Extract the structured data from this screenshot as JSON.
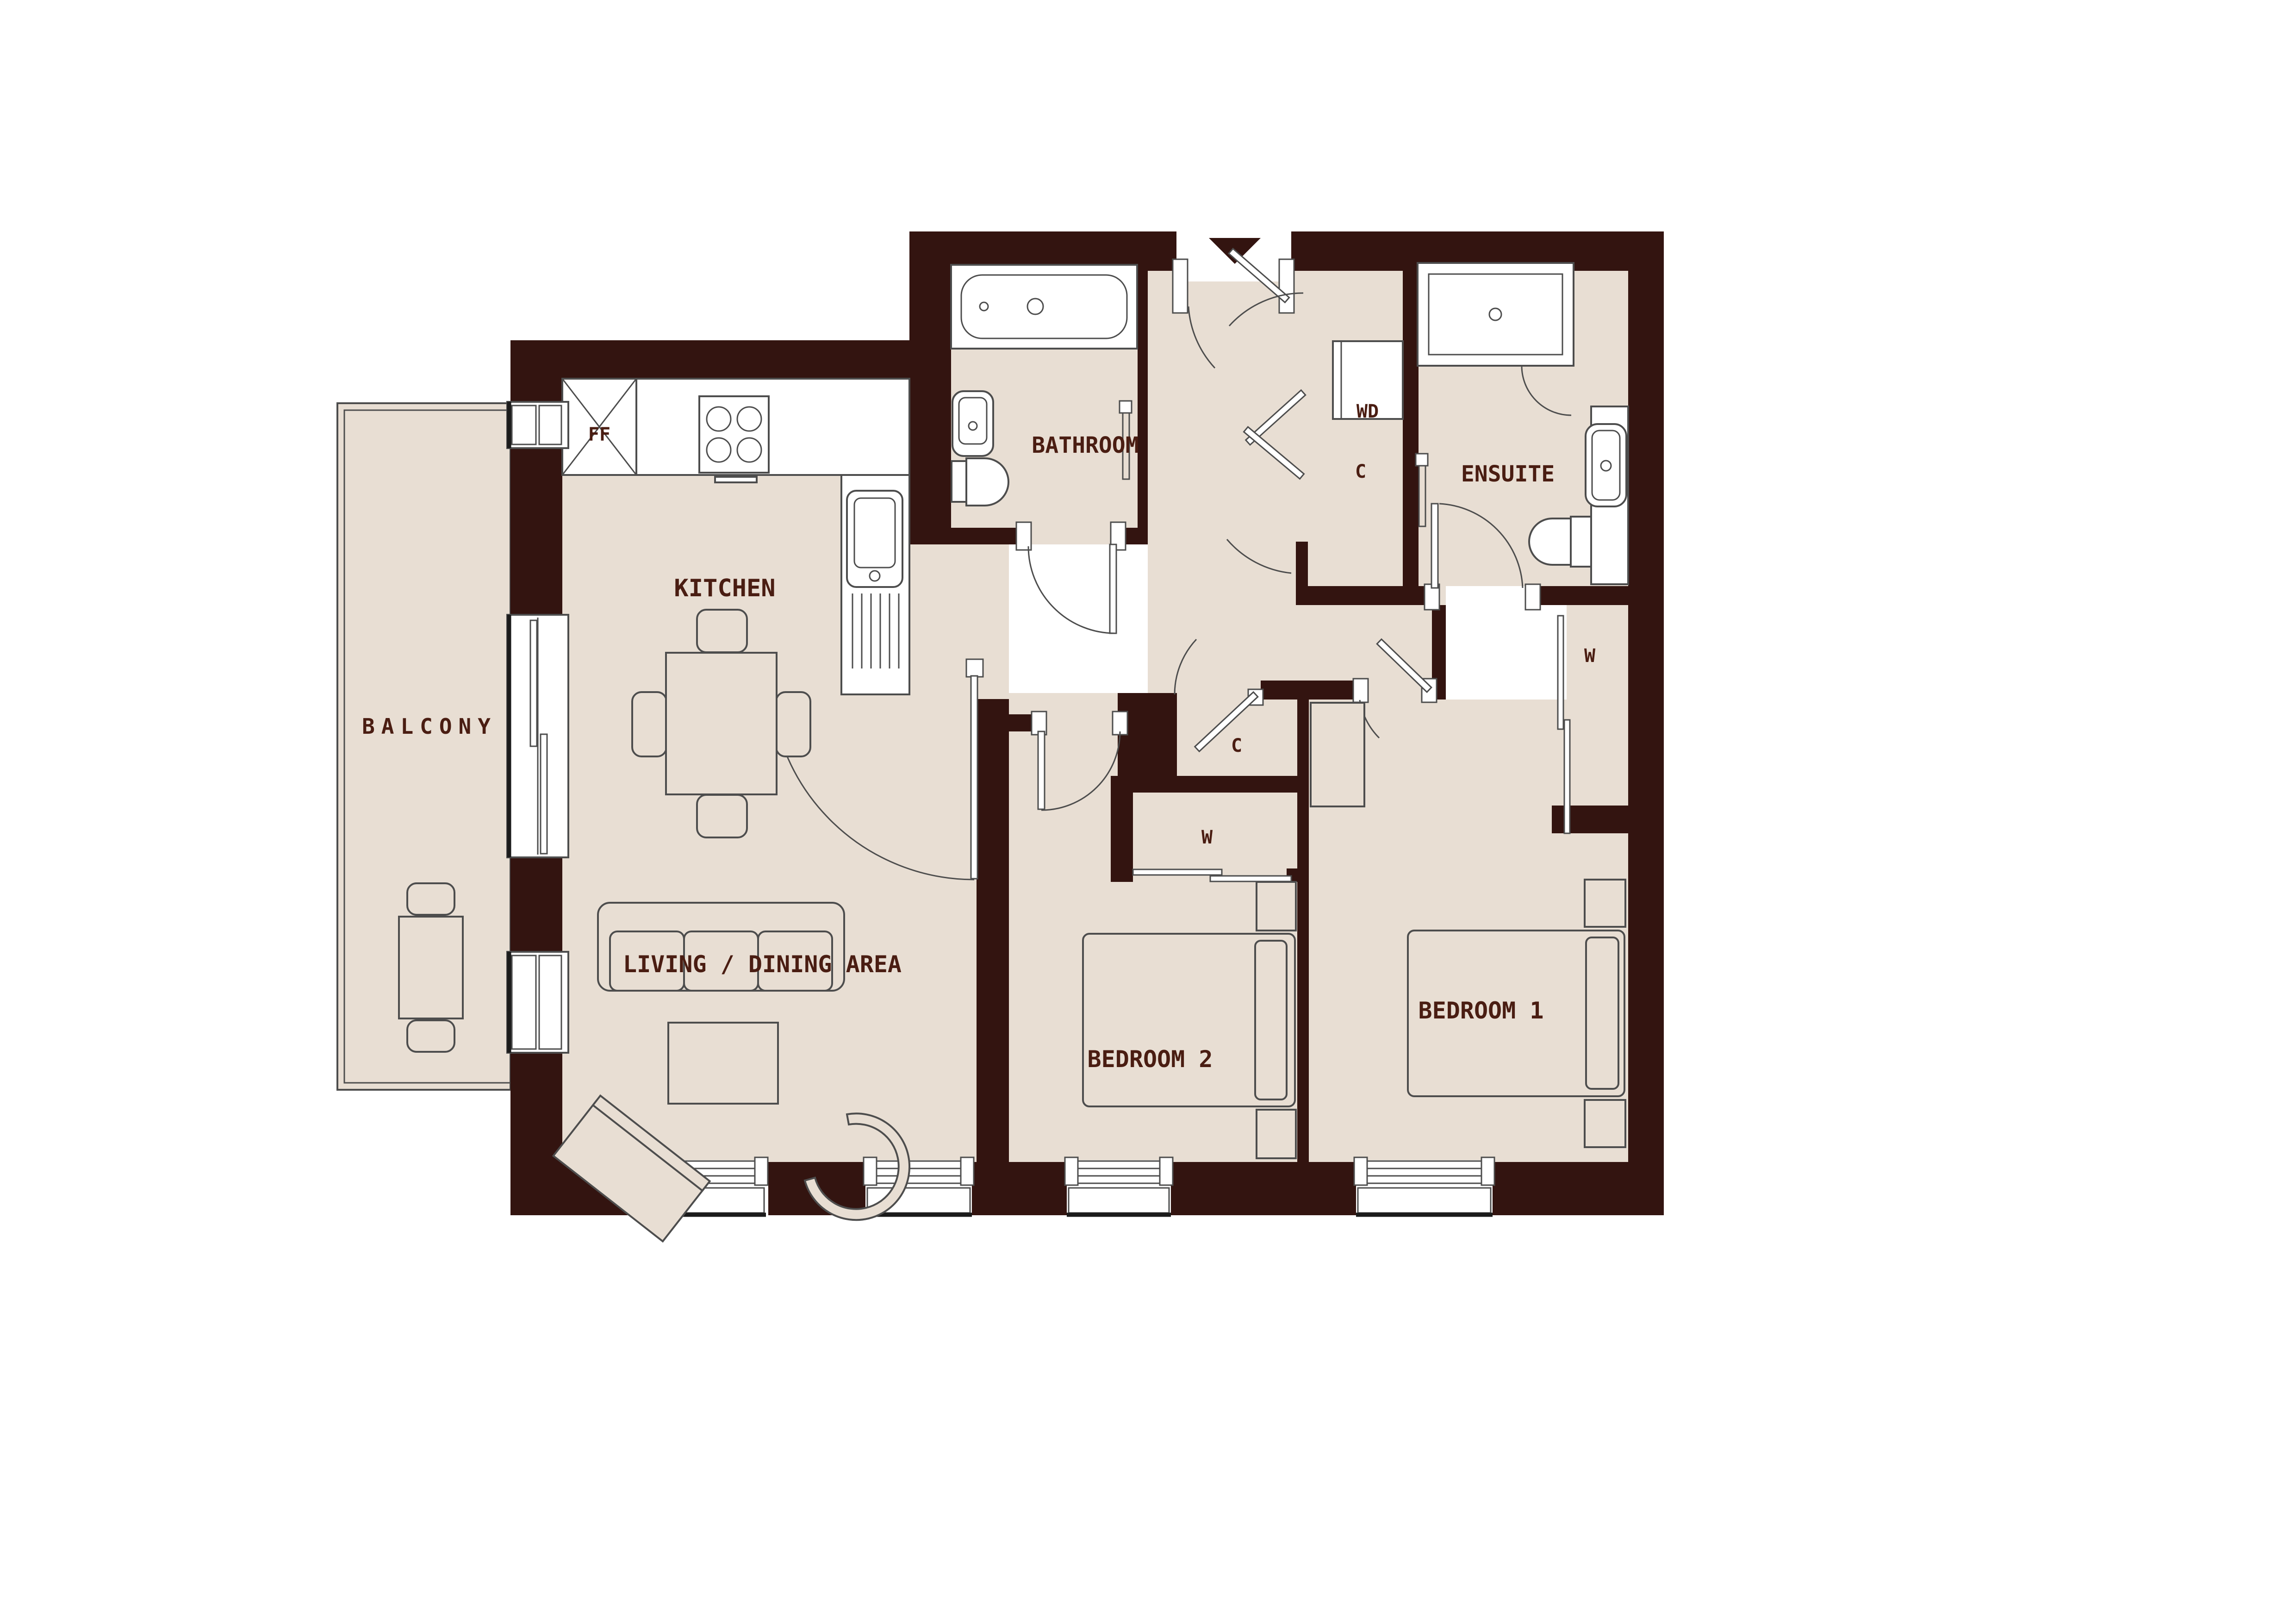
{
  "plan": {
    "type": "apartment-floor-plan",
    "colors": {
      "wall": "#331410",
      "floor": "#e8ded3",
      "outline": "#4d4d4d",
      "label": "#4a1d12",
      "background": "#ffffff"
    },
    "labels": {
      "kitchen": "KITCHEN",
      "living_dining": "LIVING / DINING AREA",
      "balcony": "BALCONY",
      "bathroom": "BATHROOM",
      "ensuite": "ENSUITE",
      "bedroom1": "BEDROOM 1",
      "bedroom2": "BEDROOM 2",
      "fridge_freezer": "FF",
      "washer_dryer": "WD",
      "hall_closet": "C",
      "bedroom2_closet": "C",
      "bedroom2_wardrobe": "W",
      "bedroom1_wardrobe": "W"
    },
    "features": {
      "entry_marker": "down-arrow at main entrance, top of plan",
      "rooms": [
        "Kitchen",
        "Living / Dining Area",
        "Balcony",
        "Bathroom",
        "Ensuite",
        "Bedroom 1",
        "Bedroom 2"
      ],
      "storage": [
        "WD closet (C)",
        "Hall closet (C)",
        "Wardrobe (W) x2"
      ]
    }
  }
}
